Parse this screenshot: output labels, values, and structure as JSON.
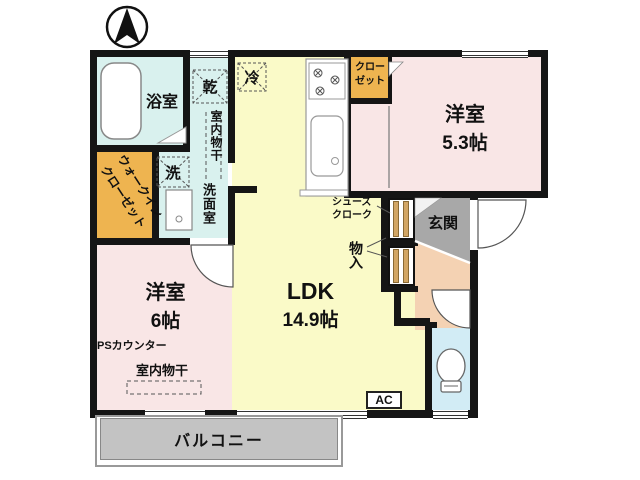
{
  "plan": {
    "compass": "north-arrow",
    "labels": {
      "bath": "浴室",
      "dryer": "乾",
      "fridge": "冷",
      "indoor_drying_washroom": "室内物干",
      "washer": "洗",
      "washroom": "洗面室",
      "wic_line1": "ウォークイン",
      "wic_line2": "クローゼット",
      "closet_line1": "クロー",
      "closet_line2": "ゼット",
      "bedroom53_name": "洋室",
      "bedroom53_size": "5.3帖",
      "genkan": "玄関",
      "shoes_line1": "シューズ",
      "shoes_line2": "クローク",
      "storage": "物入",
      "ldk_name": "LDK",
      "ldk_size": "14.9帖",
      "bedroom6_name": "洋室",
      "bedroom6_size": "6帖",
      "ps_counter": "PSカウンター",
      "indoor_drying_bedroom": "室内物干",
      "ac": "AC",
      "balcony": "バルコニー"
    },
    "colors": {
      "wall": "#151515",
      "bath_washroom": "#d9f1ee",
      "ldk": "#fafac8",
      "bedroom": "#f9e6e6",
      "closet": "#eeb450",
      "closet_door_stripe": "#d2a665",
      "genkan": "#a8a8a8",
      "hallway": "#f4d2b3",
      "toilet": "#d2ecf5",
      "balcony": "#c3c3c3"
    }
  }
}
